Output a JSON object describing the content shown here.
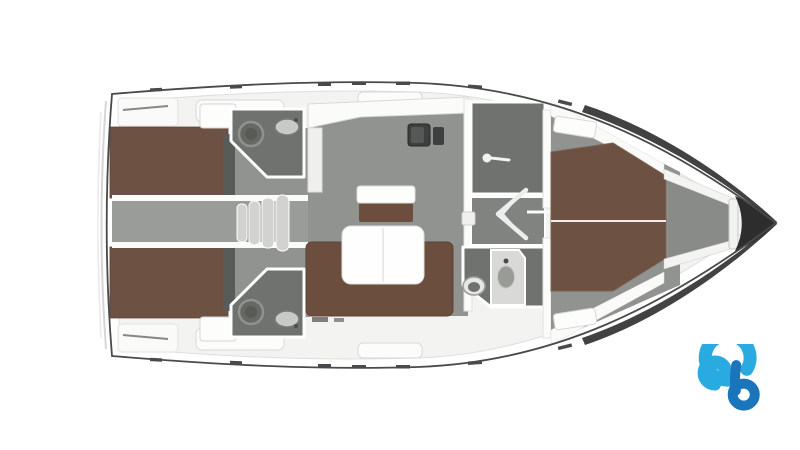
{
  "page": {
    "background": "#ffffff"
  },
  "floorplan": {
    "title": "Sailing yacht interior floor plan, top view",
    "colors": {
      "hull": "#4a4a4a",
      "bow": "#2d2d2d",
      "deck": "#f6f6f5",
      "trim": "#fbfbfa",
      "berth": "#6d5142",
      "sofa": "#6c4e3e",
      "floor": "#919390",
      "bath": "#6f726e",
      "passage": "#80837f",
      "fixture": "#3e403f",
      "table": "#fefefe",
      "steps": "#d2d3d1",
      "logo-light": "#29abe2",
      "logo-dark": "#1b75bb"
    },
    "rooms": {
      "aft_cabin_port": {
        "furniture": [
          "double-berth",
          "wardrobe"
        ]
      },
      "aft_cabin_starboard": {
        "furniture": [
          "double-berth",
          "wardrobe"
        ]
      },
      "aft_head_port": {
        "fixtures": [
          "toilet",
          "sink"
        ]
      },
      "aft_head_starboard": {
        "fixtures": [
          "toilet",
          "sink"
        ]
      },
      "companionway": {
        "steps": 4
      },
      "salon": {
        "furniture": [
          "u-sofa",
          "dining-table",
          "nav-seat"
        ]
      },
      "galley": {
        "fixtures": [
          "sink",
          "stove"
        ]
      },
      "shower_room": {
        "fixtures": [
          "shower-head"
        ]
      },
      "forward_head": {
        "fixtures": [
          "toilet",
          "sink-cabinet"
        ]
      },
      "forward_cabin": {
        "furniture": [
          "v-berth",
          "shelves"
        ]
      },
      "anchor_locker": {
        "fixtures": []
      }
    },
    "logo": {
      "name": "boataround-logo"
    }
  }
}
